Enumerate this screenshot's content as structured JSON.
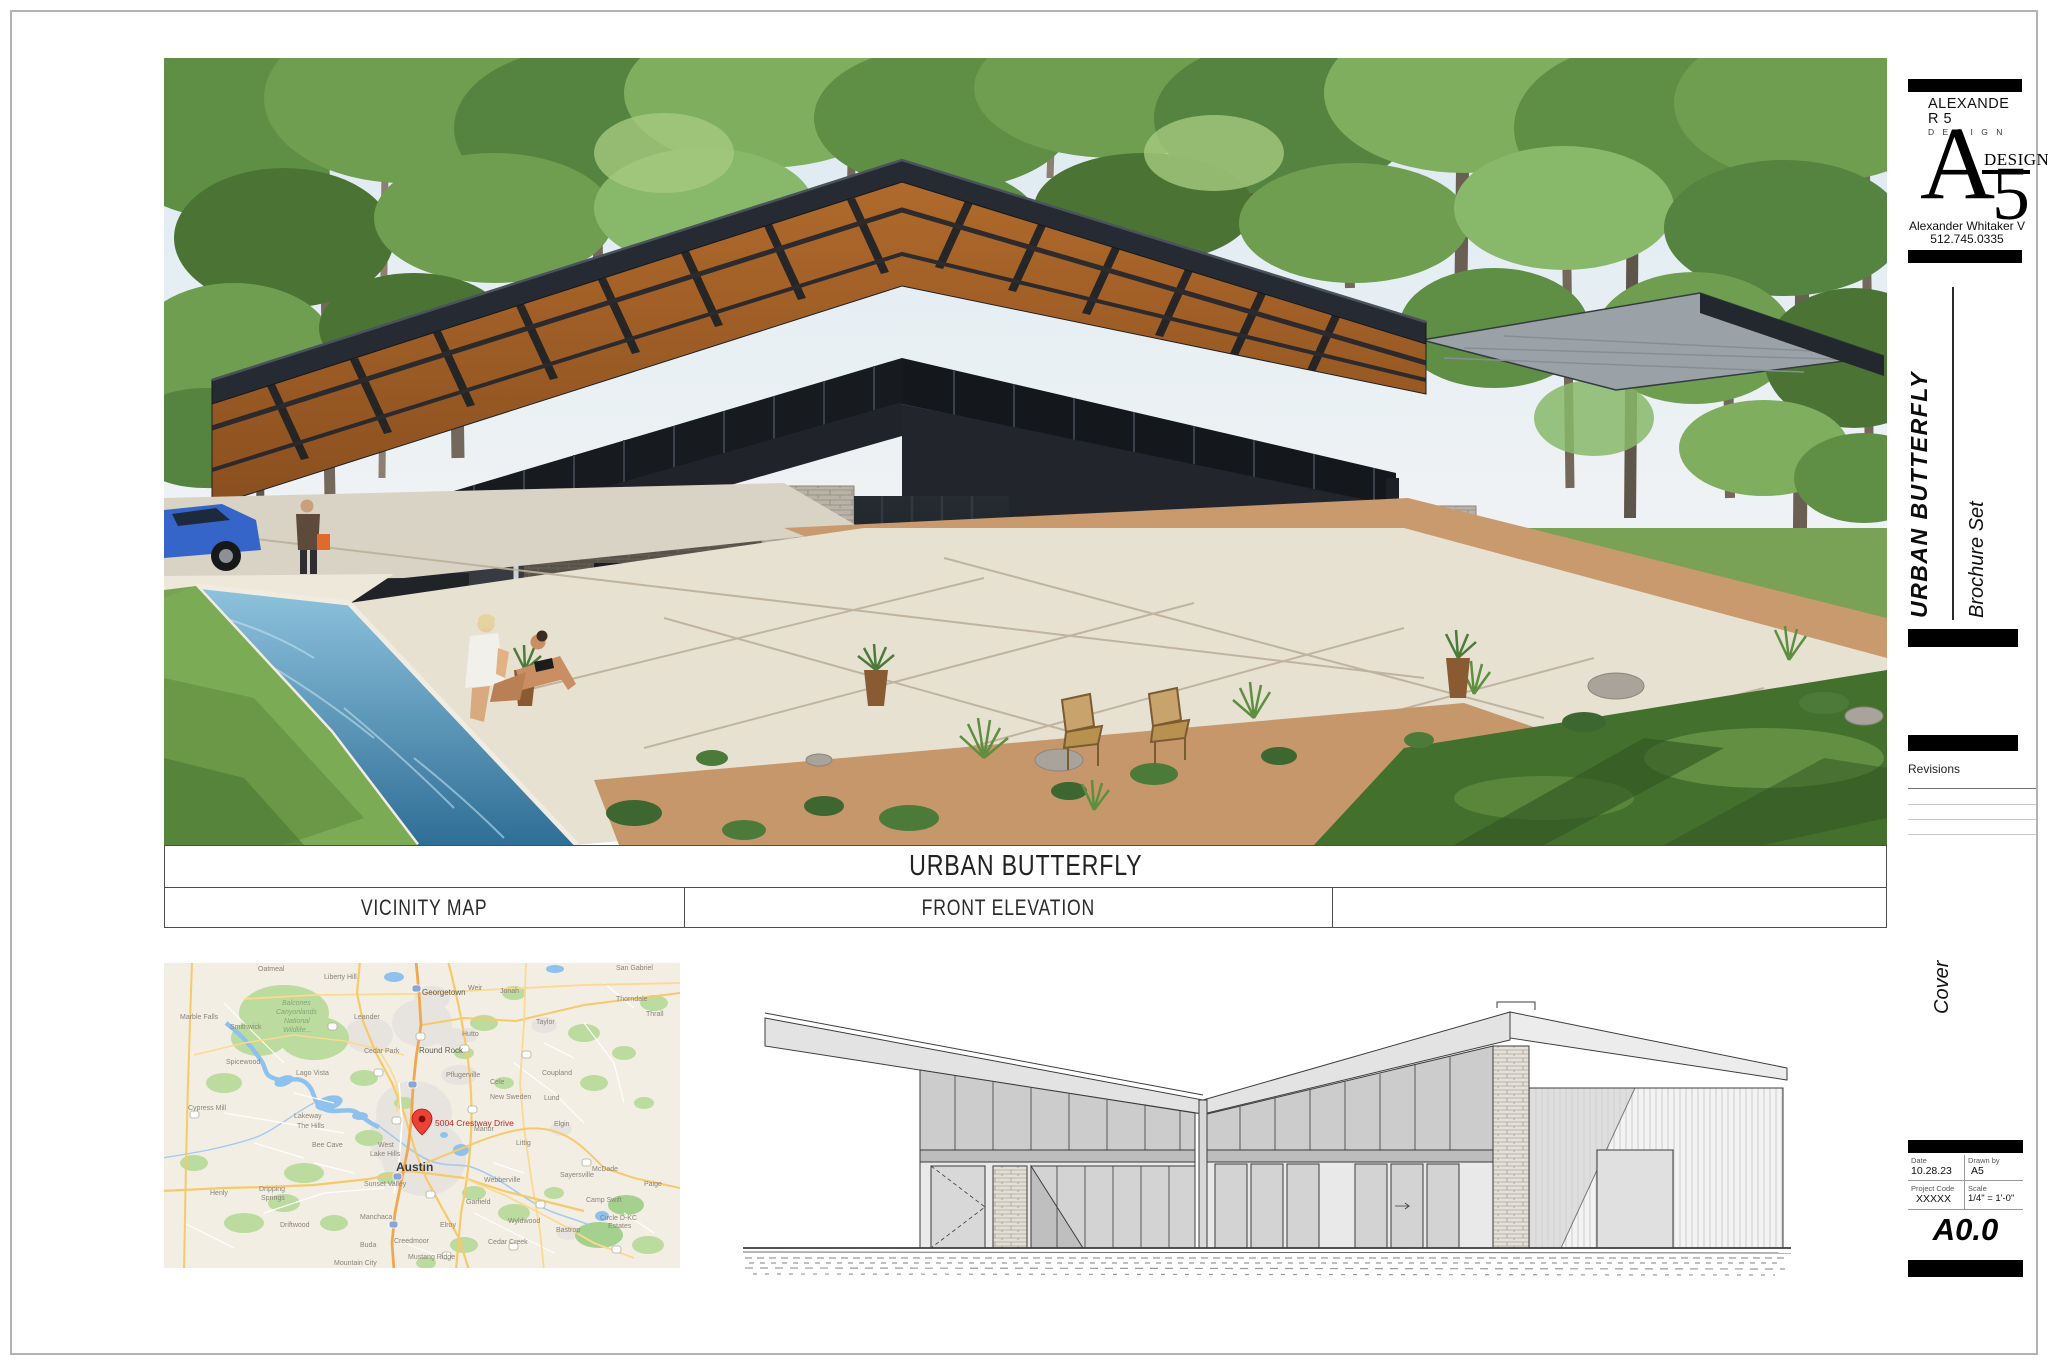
{
  "firm": {
    "name_line1": "ALEXANDE",
    "name_line2": "R 5",
    "name_sub": "D E S I G N",
    "mark_a": "A",
    "mark_design": "DESIGN",
    "mark_5": "5",
    "contact_name": "Alexander Whitaker V",
    "contact_phone": "512.745.0335"
  },
  "titlebar": {
    "project": "URBAN BUTTERFLY",
    "left_panel": "VICINITY MAP",
    "center_panel": "FRONT ELEVATION",
    "right_panel": ""
  },
  "sidebar": {
    "project_vertical": "URBAN BUTTERFLY",
    "set_name": "Brochure Set",
    "revisions_label": "Revisions",
    "sheet_title_vertical": "Cover",
    "date_label": "Date",
    "date": "10.28.23",
    "drawn_label": "Drawn by",
    "drawn_by": "A5",
    "code_label": "Project Code",
    "project_code": "XXXXX",
    "scale_label": "Scale",
    "scale": "1/4\" = 1'-0\"",
    "sheet_number": "A0.0"
  },
  "map": {
    "pin_label": "5004 Crestway Drive",
    "labels": [
      {
        "t": "Oatmeal",
        "x": 94,
        "y": 8
      },
      {
        "t": "Liberty Hill",
        "x": 160,
        "y": 16
      },
      {
        "t": "Georgetown",
        "x": 258,
        "y": 32,
        "c": "b1"
      },
      {
        "t": "Weir",
        "x": 304,
        "y": 27
      },
      {
        "t": "Jonah",
        "x": 336,
        "y": 30
      },
      {
        "t": "San Gabriel",
        "x": 452,
        "y": 7
      },
      {
        "t": "Thorndale",
        "x": 452,
        "y": 38
      },
      {
        "t": "Thrall",
        "x": 482,
        "y": 53
      },
      {
        "t": "Taylor",
        "x": 372,
        "y": 61
      },
      {
        "t": "Hutto",
        "x": 298,
        "y": 73
      },
      {
        "t": "Round Rock",
        "x": 255,
        "y": 90,
        "c": "b1"
      },
      {
        "t": "Cedar Park",
        "x": 200,
        "y": 90
      },
      {
        "t": "Leander",
        "x": 190,
        "y": 56
      },
      {
        "t": "Marble Falls",
        "x": 16,
        "y": 56
      },
      {
        "t": "Smithwick",
        "x": 66,
        "y": 66
      },
      {
        "t": "Balcones",
        "x": 118,
        "y": 42,
        "c": "g"
      },
      {
        "t": "Canyonlands",
        "x": 112,
        "y": 51,
        "c": "g"
      },
      {
        "t": "National",
        "x": 120,
        "y": 60,
        "c": "g"
      },
      {
        "t": "Wildlife...",
        "x": 119,
        "y": 69,
        "c": "g"
      },
      {
        "t": "Spicewood",
        "x": 62,
        "y": 101
      },
      {
        "t": "Lago Vista",
        "x": 132,
        "y": 112
      },
      {
        "t": "Pflugerville",
        "x": 282,
        "y": 114
      },
      {
        "t": "Cele",
        "x": 326,
        "y": 121
      },
      {
        "t": "Coupland",
        "x": 378,
        "y": 112
      },
      {
        "t": "New Sweden",
        "x": 326,
        "y": 136
      },
      {
        "t": "Lund",
        "x": 380,
        "y": 137
      },
      {
        "t": "Cypress Mill",
        "x": 24,
        "y": 147
      },
      {
        "t": "Lakeway",
        "x": 130,
        "y": 155
      },
      {
        "t": "The Hills",
        "x": 133,
        "y": 165
      },
      {
        "t": "Bee Cave",
        "x": 148,
        "y": 184
      },
      {
        "t": "West",
        "x": 214,
        "y": 184
      },
      {
        "t": "Lake Hills",
        "x": 206,
        "y": 193
      },
      {
        "t": "Austin",
        "x": 232,
        "y": 208,
        "c": "b2"
      },
      {
        "t": "Sunset Valley",
        "x": 200,
        "y": 223
      },
      {
        "t": "Manor",
        "x": 310,
        "y": 168
      },
      {
        "t": "Littig",
        "x": 352,
        "y": 182
      },
      {
        "t": "Elgin",
        "x": 390,
        "y": 163
      },
      {
        "t": "Henly",
        "x": 46,
        "y": 232
      },
      {
        "t": "Dripping",
        "x": 95,
        "y": 228
      },
      {
        "t": "Springs",
        "x": 97,
        "y": 237
      },
      {
        "t": "Driftwood",
        "x": 116,
        "y": 264
      },
      {
        "t": "Manchaca",
        "x": 196,
        "y": 256
      },
      {
        "t": "Buda",
        "x": 196,
        "y": 284
      },
      {
        "t": "Creedmoor",
        "x": 230,
        "y": 280
      },
      {
        "t": "Mustang Ridge",
        "x": 244,
        "y": 296
      },
      {
        "t": "Elroy",
        "x": 276,
        "y": 264
      },
      {
        "t": "Garfield",
        "x": 302,
        "y": 241
      },
      {
        "t": "Webberville",
        "x": 320,
        "y": 219
      },
      {
        "t": "Sayersville",
        "x": 396,
        "y": 214
      },
      {
        "t": "McDade",
        "x": 428,
        "y": 208
      },
      {
        "t": "Paige",
        "x": 480,
        "y": 223
      },
      {
        "t": "Camp Swift",
        "x": 422,
        "y": 239
      },
      {
        "t": "Circle D-KC",
        "x": 436,
        "y": 257
      },
      {
        "t": "Estates",
        "x": 444,
        "y": 265
      },
      {
        "t": "Wyldwood",
        "x": 344,
        "y": 260
      },
      {
        "t": "Bastrop",
        "x": 392,
        "y": 269
      },
      {
        "t": "Cedar Creek",
        "x": 324,
        "y": 281
      },
      {
        "t": "Mountain City",
        "x": 170,
        "y": 302
      }
    ]
  }
}
